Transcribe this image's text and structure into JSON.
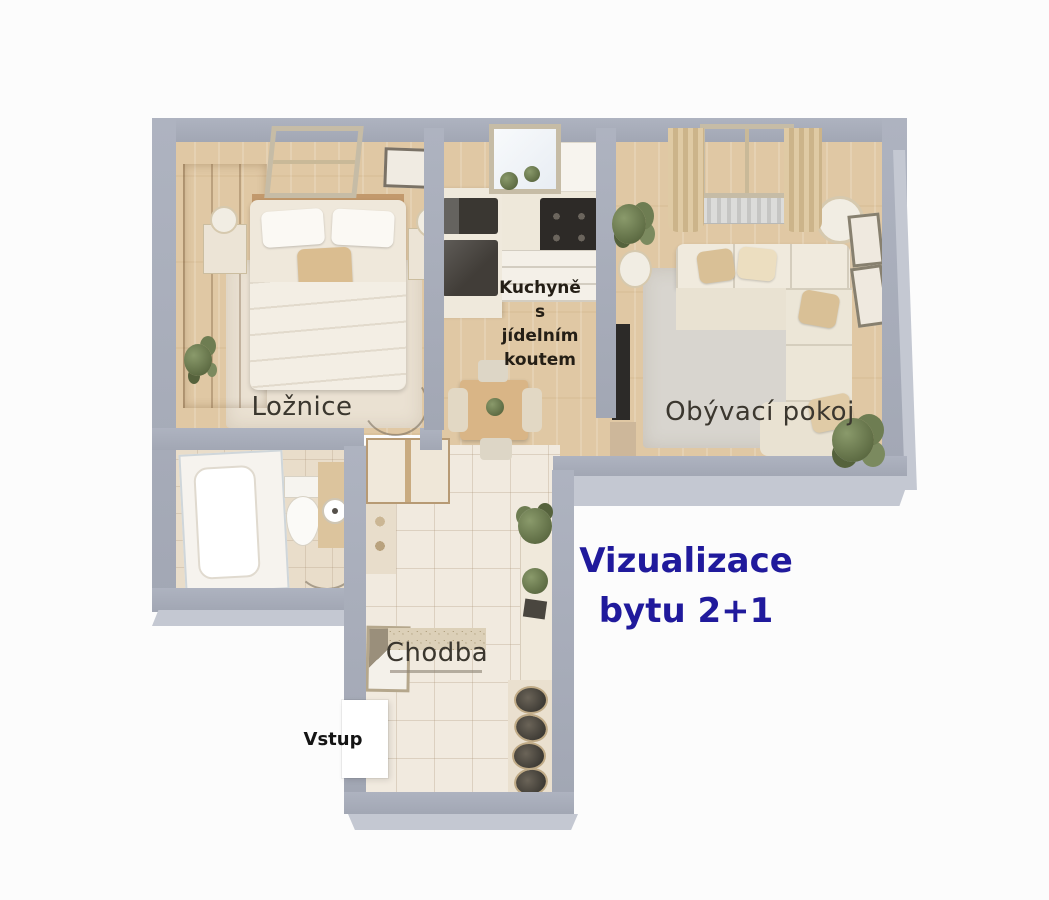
{
  "title": {
    "text": "Vizualizace\nbytu 2+1",
    "color": "#201a9c"
  },
  "rooms": {
    "bedroom": {
      "label": "Ložnice"
    },
    "kitchen": {
      "label": "Kuchyně\ns\njídelním\nkoutem"
    },
    "living_room": {
      "label": "Obývací pokoj"
    },
    "hallway": {
      "label": "Chodba"
    },
    "entrance": {
      "label": "Vstup"
    }
  },
  "colors": {
    "wall_top": "#a8adba",
    "wall_face": "#c4c8d2",
    "wood_floor": "#e0c8a4",
    "hall_tile": "#f1eadf",
    "bath_tile": "#e9ddca",
    "bedroom_rug": "#eae1d2",
    "living_rug": "#d8d5cf",
    "furniture_wood": "#c9a272",
    "sofa_cream": "#efe9dc",
    "title_blue": "#201a9c",
    "background": "#fcfcfc"
  }
}
